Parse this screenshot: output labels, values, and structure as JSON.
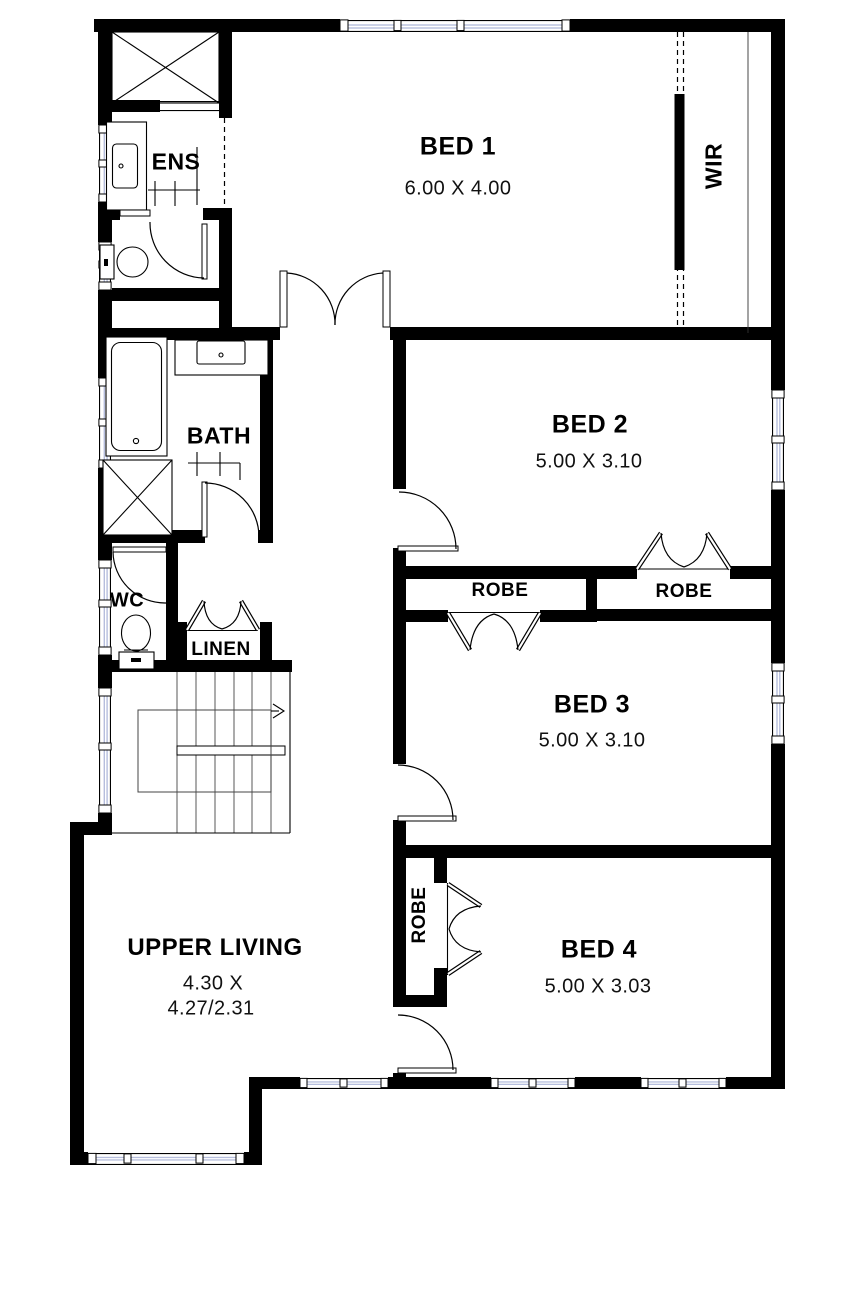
{
  "plan": {
    "colors": {
      "wall": "#000000",
      "glazing": "#b6bedd",
      "background": "#ffffff",
      "stair_tread": "#666666"
    },
    "rooms": {
      "bed1": {
        "name": "BED 1",
        "dimensions": "6.00 X 4.00"
      },
      "bed2": {
        "name": "BED 2",
        "dimensions": "5.00 X 3.10"
      },
      "bed3": {
        "name": "BED 3",
        "dimensions": "5.00 X 3.10"
      },
      "bed4": {
        "name": "BED 4",
        "dimensions": "5.00 X 3.03"
      },
      "upper_living": {
        "name": "UPPER LIVING",
        "dimensions_line1": "4.30 X",
        "dimensions_line2": "4.27/2.31"
      },
      "ens": {
        "name": "ENS"
      },
      "bath": {
        "name": "BATH"
      },
      "wc": {
        "name": "WC"
      },
      "linen": {
        "name": "LINEN"
      },
      "wir": {
        "name": "WIR"
      },
      "robe_bed2": {
        "name": "ROBE"
      },
      "robe_bed3": {
        "name": "ROBE"
      },
      "robe_bed4": {
        "name": "ROBE"
      }
    }
  }
}
